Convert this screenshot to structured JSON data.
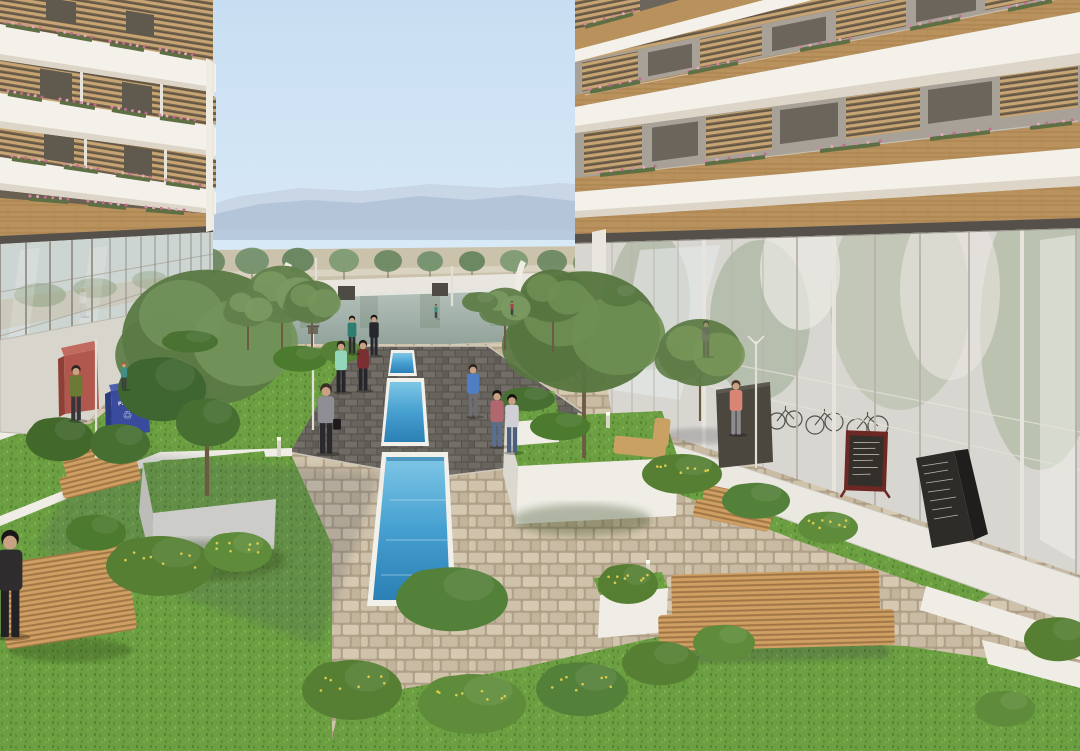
{
  "scene": {
    "description": "Architectural rendering of a residential courtyard between two modern apartment buildings with wood-slat balconies, a long narrow blue pool, lawns, planters, wooden benches and pedestrians; mountains on the horizon."
  },
  "signs": {
    "paper_bin_label": "PAPER",
    "recycle_symbol": "♲",
    "menu_boards": [
      "red-framed chalkboard menu (illegible)",
      "black a-frame chalkboard menu (illegible)"
    ]
  },
  "palette": {
    "sky_top": "#c7def2",
    "sky_bottom": "#eef6fc",
    "mountain": "#aebfd6",
    "mountain_far": "#c6d4e4",
    "pond_top": "#b7c3bd",
    "pond_bottom": "#8d9f97",
    "pool_top": "#7ec6e6",
    "pool_bottom": "#2b7fb4",
    "grass": "#6b9f41",
    "cobble": "#af9f87",
    "brick": "#55504a",
    "band_white": "#f4f1ea",
    "band_shade": "#ddd6c8",
    "wood": "#b9915c",
    "recess_wall_left": "#847a6b",
    "recess_wall_right": "#a8a198",
    "window_dark": "#60594d",
    "glass_left": "#cdd5d2",
    "glass_right": "#d8d6d0",
    "walkway_left": "#d8d5cc",
    "walkway_right": "#eae8e1",
    "planter_white": "#efede6",
    "bench_wood": "#c89a5b",
    "bin_blue": "#3a4a9c",
    "kiosk_red": "#b2574d",
    "board_frame_red": "#6e2823",
    "board_black": "#2e2c29",
    "flower_pink": "#d884a6"
  },
  "people": [
    {
      "x": 76,
      "y": 420,
      "h": 56,
      "top": "#6b7a34",
      "pants": "#35353a",
      "hair": "#2c2620"
    },
    {
      "x": 124,
      "y": 389,
      "h": 27,
      "top": "#3f8f86",
      "pants": "#3c3c40",
      "hair": "#b5552e"
    },
    {
      "x": 341,
      "y": 392,
      "h": 52,
      "top": "#93d6ba",
      "pants": "#26262a",
      "hair": "#2c2620"
    },
    {
      "x": 363,
      "y": 390,
      "h": 51,
      "top": "#7a2f33",
      "pants": "#26262a",
      "hair": "#1e1a18"
    },
    {
      "x": 374,
      "y": 355,
      "h": 41,
      "top": "#26282e",
      "pants": "#26282e",
      "hair": "#16130f"
    },
    {
      "x": 352,
      "y": 353,
      "h": 38,
      "top": "#2e7d6e",
      "pants": "#2b2b30",
      "hair": "#16130f"
    },
    {
      "x": 326,
      "y": 453,
      "h": 71,
      "top": "#8e8e94",
      "pants": "#2a2a2e",
      "hair": "#3a302a",
      "bag": true
    },
    {
      "x": 473,
      "y": 416,
      "h": 53,
      "top": "#4f7fc2",
      "pants": "#6e6e72",
      "hair": "#2c2620"
    },
    {
      "x": 497,
      "y": 446,
      "h": 57,
      "top": "#b0686e",
      "pants": "#5b6e8e",
      "hair": "#16130f"
    },
    {
      "x": 512,
      "y": 452,
      "h": 59,
      "top": "#cfcfd4",
      "pants": "#4d5f80",
      "hair": "#16130f"
    },
    {
      "x": 736,
      "y": 434,
      "h": 55,
      "top": "#d98576",
      "pants": "#8b8b90",
      "hair": "#4a342a"
    },
    {
      "x": 436,
      "y": 318,
      "h": 14,
      "top": "#3f8f86",
      "pants": "#333338",
      "hair": "#222222"
    },
    {
      "x": 512,
      "y": 315,
      "h": 14,
      "top": "#a04848",
      "pants": "#333338",
      "hair": "#222222"
    },
    {
      "x": 706,
      "y": 356,
      "h": 36,
      "top": "#6e6a66",
      "pants": "#55524e",
      "hair": "#333333",
      "op": 0.55
    },
    {
      "x": 83,
      "y": 316,
      "h": 30,
      "top": "#e2e2e4",
      "pants": "#b9b9be",
      "hair": "#cfcfd2",
      "op": 0.4
    },
    {
      "x": 10,
      "y": 636,
      "h": 108,
      "top": "#2f2c2e",
      "pants": "#242124",
      "hair": "#1a1718"
    }
  ],
  "trees": [
    {
      "x": 207,
      "y": 496,
      "h": 220,
      "r": 85,
      "c1": "#5b7a45",
      "c2": "#72935a"
    },
    {
      "x": 584,
      "y": 458,
      "h": 175,
      "r": 76,
      "c1": "#57763f",
      "c2": "#6e8f53"
    },
    {
      "x": 700,
      "y": 421,
      "h": 95,
      "r": 42,
      "c1": "#5f7c48",
      "c2": "#789659"
    },
    {
      "x": 282,
      "y": 352,
      "h": 80,
      "r": 36,
      "c1": "#62804b",
      "c2": "#7b9a62"
    },
    {
      "x": 312,
      "y": 348,
      "h": 64,
      "r": 27,
      "c1": "#5e7c48",
      "c2": "#76955c"
    },
    {
      "x": 248,
      "y": 350,
      "h": 58,
      "r": 23,
      "c1": "#62804b",
      "c2": "#7b9a62"
    },
    {
      "x": 553,
      "y": 352,
      "h": 78,
      "r": 33,
      "c1": "#57763f",
      "c2": "#6e8f53"
    },
    {
      "x": 505,
      "y": 350,
      "h": 60,
      "r": 24,
      "c1": "#62804b",
      "c2": "#7b9a62"
    }
  ],
  "bushes": [
    {
      "x": 160,
      "y": 578,
      "rx": 54,
      "ry": 30,
      "c": "#567f33",
      "fl": 1
    },
    {
      "x": 238,
      "y": 560,
      "rx": 34,
      "ry": 20,
      "c": "#5f8c3a",
      "fl": 1
    },
    {
      "x": 96,
      "y": 540,
      "rx": 30,
      "ry": 18,
      "c": "#4c7a2e",
      "fl": 0
    },
    {
      "x": 452,
      "y": 612,
      "rx": 56,
      "ry": 32,
      "c": "#54813a",
      "fl": 0
    },
    {
      "x": 352,
      "y": 702,
      "rx": 50,
      "ry": 30,
      "c": "#567f33",
      "fl": 1
    },
    {
      "x": 472,
      "y": 716,
      "rx": 54,
      "ry": 30,
      "c": "#5f8c3a",
      "fl": 1
    },
    {
      "x": 582,
      "y": 700,
      "rx": 46,
      "ry": 27,
      "c": "#54813a",
      "fl": 1
    },
    {
      "x": 660,
      "y": 672,
      "rx": 38,
      "ry": 22,
      "c": "#567f33",
      "fl": 0
    },
    {
      "x": 724,
      "y": 650,
      "rx": 31,
      "ry": 18,
      "c": "#5f8c3a",
      "fl": 0
    },
    {
      "x": 162,
      "y": 402,
      "rx": 44,
      "ry": 32,
      "c": "#3f6530",
      "fl": 0
    },
    {
      "x": 208,
      "y": 432,
      "rx": 32,
      "ry": 24,
      "c": "#486f32",
      "fl": 0
    },
    {
      "x": 60,
      "y": 448,
      "rx": 34,
      "ry": 22,
      "c": "#42682c",
      "fl": 0
    },
    {
      "x": 120,
      "y": 452,
      "rx": 30,
      "ry": 20,
      "c": "#486f32",
      "fl": 0
    },
    {
      "x": 682,
      "y": 482,
      "rx": 40,
      "ry": 20,
      "c": "#567f33",
      "fl": 1
    },
    {
      "x": 756,
      "y": 508,
      "rx": 34,
      "ry": 18,
      "c": "#54813a",
      "fl": 0
    },
    {
      "x": 828,
      "y": 534,
      "rx": 30,
      "ry": 16,
      "c": "#5f8c3a",
      "fl": 1
    },
    {
      "x": 300,
      "y": 364,
      "rx": 27,
      "ry": 13,
      "c": "#4c7a2e",
      "fl": 0
    },
    {
      "x": 342,
      "y": 356,
      "rx": 22,
      "ry": 11,
      "c": "#557f36",
      "fl": 0
    },
    {
      "x": 528,
      "y": 404,
      "rx": 27,
      "ry": 12,
      "c": "#486f32",
      "fl": 0
    },
    {
      "x": 560,
      "y": 432,
      "rx": 30,
      "ry": 14,
      "c": "#4c7a2e",
      "fl": 0
    },
    {
      "x": 190,
      "y": 346,
      "rx": 28,
      "ry": 11,
      "c": "#4a7233",
      "fl": 0
    },
    {
      "x": 628,
      "y": 592,
      "rx": 30,
      "ry": 20,
      "c": "#567f33",
      "fl": 1
    },
    {
      "x": 1058,
      "y": 648,
      "rx": 34,
      "ry": 22,
      "c": "#567f33",
      "fl": 0
    },
    {
      "x": 1005,
      "y": 716,
      "rx": 30,
      "ry": 18,
      "c": "#5f8c3a",
      "fl": 0
    },
    {
      "x": 620,
      "y": 300,
      "rx": 20,
      "ry": 11,
      "c": "#5a7a44",
      "fl": 0
    },
    {
      "x": 480,
      "y": 306,
      "rx": 18,
      "ry": 10,
      "c": "#62804b",
      "fl": 0
    }
  ],
  "background_trees": [
    {
      "x": 70,
      "y": 300,
      "r": 26,
      "h": 52,
      "c": "#72906a"
    },
    {
      "x": 118,
      "y": 296,
      "r": 22,
      "h": 46,
      "c": "#64835c"
    },
    {
      "x": 163,
      "y": 292,
      "r": 20,
      "h": 42,
      "c": "#7d9a72"
    },
    {
      "x": 207,
      "y": 289,
      "r": 18,
      "h": 40,
      "c": "#6a8862"
    },
    {
      "x": 252,
      "y": 286,
      "r": 17,
      "h": 37,
      "c": "#72906a"
    },
    {
      "x": 298,
      "y": 284,
      "r": 16,
      "h": 35,
      "c": "#64835c"
    },
    {
      "x": 344,
      "y": 283,
      "r": 15,
      "h": 33,
      "c": "#7d9a72"
    },
    {
      "x": 388,
      "y": 282,
      "r": 14,
      "h": 31,
      "c": "#6a8862"
    },
    {
      "x": 430,
      "y": 281,
      "r": 13,
      "h": 29,
      "c": "#72906a"
    },
    {
      "x": 472,
      "y": 281,
      "r": 13,
      "h": 29,
      "c": "#64835c"
    },
    {
      "x": 514,
      "y": 282,
      "r": 14,
      "h": 31,
      "c": "#7d9a72"
    },
    {
      "x": 552,
      "y": 284,
      "r": 15,
      "h": 33,
      "c": "#6a8862"
    },
    {
      "x": 590,
      "y": 288,
      "r": 17,
      "h": 37,
      "c": "#72906a"
    },
    {
      "x": 628,
      "y": 293,
      "r": 20,
      "h": 42,
      "c": "#64835c"
    }
  ],
  "lamps": [
    {
      "type": "cross",
      "x": 96,
      "y1": 334,
      "y2": 458
    },
    {
      "type": "lantern",
      "x": 313,
      "y1": 327,
      "y2": 430
    },
    {
      "type": "vee",
      "x": 756,
      "y1": 337,
      "y2": 468
    },
    {
      "type": "pole",
      "x": 316,
      "y1": 254,
      "y2": 318
    },
    {
      "type": "pole",
      "x": 452,
      "y1": 262,
      "y2": 306
    },
    {
      "type": "bollard",
      "x": 205,
      "y1": 552,
      "y2": 578
    },
    {
      "type": "bollard",
      "x": 648,
      "y1": 560,
      "y2": 586
    },
    {
      "type": "bollard",
      "x": 279,
      "y1": 437,
      "y2": 457
    },
    {
      "type": "bollard",
      "x": 608,
      "y1": 412,
      "y2": 428
    }
  ],
  "flower_boxes": [
    [
      6,
      25,
      40,
      31
    ],
    [
      58,
      34,
      92,
      40
    ],
    [
      110,
      44,
      144,
      50
    ],
    [
      160,
      52,
      192,
      58
    ],
    [
      8,
      94,
      42,
      100
    ],
    [
      60,
      102,
      95,
      108
    ],
    [
      112,
      110,
      146,
      116
    ],
    [
      160,
      118,
      195,
      123
    ],
    [
      12,
      159,
      46,
      164
    ],
    [
      64,
      167,
      98,
      172
    ],
    [
      116,
      175,
      150,
      180
    ],
    [
      166,
      183,
      200,
      188
    ],
    [
      30,
      199,
      68,
      202
    ],
    [
      88,
      204,
      126,
      208
    ],
    [
      146,
      210,
      184,
      213
    ],
    [
      585,
      27,
      633,
      14
    ],
    [
      590,
      92,
      640,
      82
    ],
    [
      688,
      73,
      738,
      63
    ],
    [
      800,
      50,
      850,
      41
    ],
    [
      910,
      29,
      960,
      19
    ],
    [
      1008,
      10,
      1052,
      1
    ],
    [
      600,
      175,
      655,
      169
    ],
    [
      705,
      164,
      765,
      157
    ],
    [
      820,
      151,
      880,
      144
    ],
    [
      930,
      139,
      990,
      132
    ],
    [
      1030,
      128,
      1072,
      123
    ]
  ],
  "bikes": [
    [
      742,
      417,
      7
    ],
    [
      757,
      415,
      7
    ],
    [
      777,
      421,
      8
    ],
    [
      794,
      419,
      8
    ],
    [
      815,
      425,
      9
    ],
    [
      834,
      422,
      9
    ],
    [
      857,
      429,
      10
    ],
    [
      878,
      426,
      10
    ]
  ]
}
